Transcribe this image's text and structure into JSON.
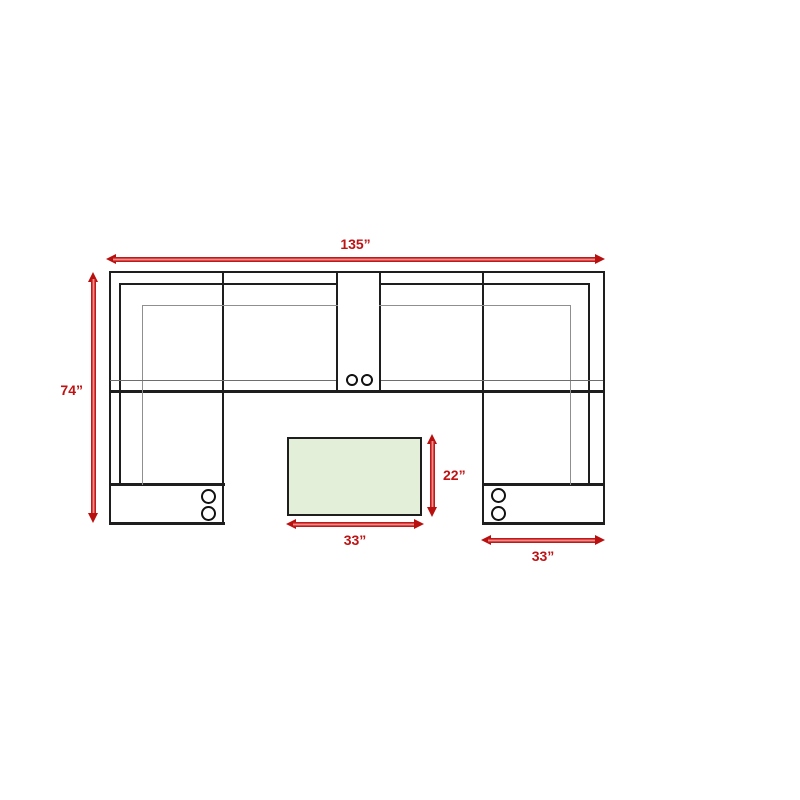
{
  "diagram": {
    "type": "sectional-sofa-floorplan",
    "units": "inches",
    "dimensions": [
      {
        "id": "overall-width",
        "label": "135”",
        "orientation": "horizontal"
      },
      {
        "id": "overall-depth",
        "label": "74”",
        "orientation": "vertical"
      },
      {
        "id": "table-depth",
        "label": "22”",
        "orientation": "vertical"
      },
      {
        "id": "table-width",
        "label": "33”",
        "orientation": "horizontal"
      },
      {
        "id": "right-chaise-width",
        "label": "33”",
        "orientation": "horizontal"
      }
    ],
    "colors": {
      "arrow_red": "#c01212",
      "table_fill_green": "#e4efd9",
      "outline_black": "#1e1e1e",
      "detail_gray": "#8f8f8f"
    },
    "icons": {
      "cupholder": "circle"
    },
    "cupholder_counts": {
      "center_console": 2,
      "left_armrest": 2,
      "right_armrest": 2
    }
  }
}
